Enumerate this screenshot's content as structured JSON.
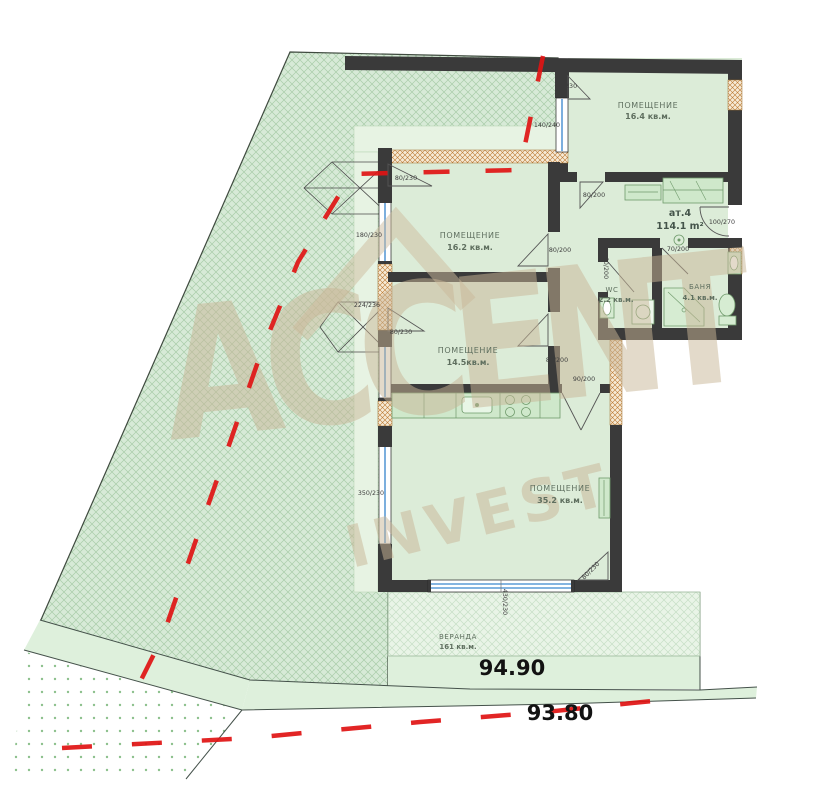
{
  "watermark": {
    "line1": "ACCENT",
    "line2": "INVEST"
  },
  "apartment": {
    "id": "ат.4",
    "area": "114.1 m²"
  },
  "rooms": [
    {
      "name": "ПОМЕЩЕНИЕ",
      "area": "16.4 кв.м."
    },
    {
      "name": "ПОМЕЩЕНИЕ",
      "area": "16.2 кв.м."
    },
    {
      "name": "ПОМЕЩЕНИЕ",
      "area": "14.5кв.м."
    },
    {
      "name": "ПОМЕЩЕНИЕ",
      "area": "35.2 кв.м."
    },
    {
      "name": "WC",
      "area": "2.2 кв.м."
    },
    {
      "name": "БАНЯ",
      "area": "4.1 кв.м."
    },
    {
      "name": "ВЕРАНДА",
      "area": "161 кв.м."
    }
  ],
  "levels": {
    "upper": "94.90",
    "lower": "93.80"
  },
  "dims": {
    "top_door": "80/230",
    "window_164": "140/240",
    "annex1_door": "80/230",
    "left_window_1": "180/230",
    "left_pier": "224/236",
    "annex2_door": "80/230",
    "left_window_2": "350/230",
    "bottom_window": "430/230",
    "bottom_door": "80/230",
    "entry_door": "100/270",
    "door_164": "80/200",
    "door_162": "80/200",
    "door_145": "80/200",
    "kitchen_pass": "90/200",
    "bath_door": "70/200",
    "wc_door": "60/200"
  },
  "colors": {
    "plot_fill": "#d7ead7",
    "hatch_line": "#a9cda9",
    "wall": "#3a3a3a",
    "masonry": "#f6ead6",
    "masonry_line": "#bc7a32",
    "boundary_red": "#e01313",
    "window_blue": "#5b9bd5",
    "watermark": "#c9b697",
    "fixture": "#cfe8cb",
    "interior": "#dcecd8"
  }
}
